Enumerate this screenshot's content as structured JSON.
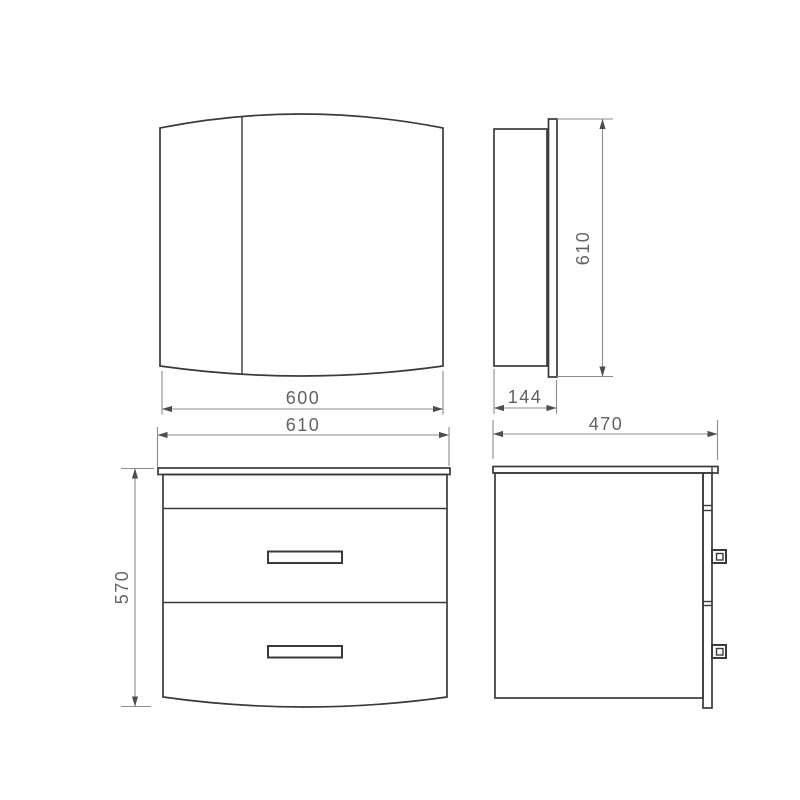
{
  "drawing": {
    "kind": "furniture technical dimension drawing",
    "colors": {
      "background": "#ffffff",
      "object_line": "#3a3a3a",
      "dimension_line": "#8c8c8c",
      "arrow": "#4d4d4d",
      "label_text": "#636363"
    },
    "dimensions": {
      "mirror_width": "600",
      "vanity_width": "610",
      "mirror_height": "610",
      "mirror_depth": "144",
      "vanity_height": "570",
      "vanity_depth": "470"
    }
  }
}
